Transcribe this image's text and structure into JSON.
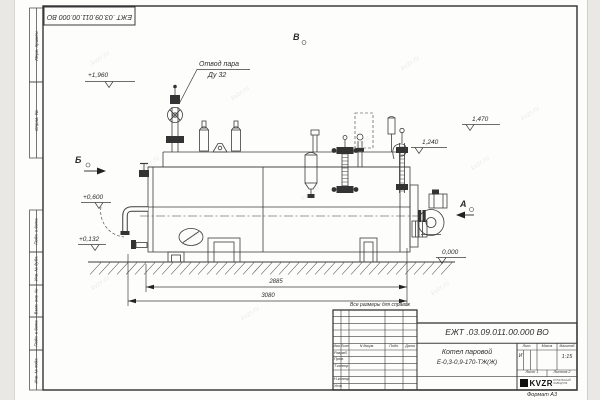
{
  "sheet": {
    "doc_number": "ЕЖТ .03.09.011.00.000  ВО",
    "format_note": "Формат А3",
    "reference_note": "Все размеры для справок",
    "watermark": "kvzr.ru"
  },
  "margin_columns": {
    "perv_primen": "Перв. примен.",
    "sprav_no": "Справ. №",
    "podp_data_1": "Подп. и дата",
    "inv_dubl": "Инв. № дубл.",
    "vzam_inv": "Взам. инв. №",
    "podp_data_2": "Подп. и дата",
    "inv_podl": "Инв. № подл."
  },
  "drawing": {
    "callout_line1": "Отвод пара",
    "callout_line2": "Ду 32",
    "view_b": "Б",
    "view_v": "В",
    "view_a": "А",
    "elev_plus_1960": "+1,960",
    "elev_plus_0600": "+0,600",
    "elev_plus_0132": "+0,132",
    "elev_1470": "1,470",
    "elev_1240": "1,240",
    "elev_0000": "0,000",
    "dim_width_inner": "2885",
    "dim_width_total": "3080"
  },
  "title_block": {
    "product_title_line1": "Котел паровой",
    "product_title_line2": "Е-0,3-0,9-170-ТЖ(Ж)",
    "col_izm": "Изм.",
    "col_list": "Лист",
    "col_doc": "N докум.",
    "col_podp": "Подп.",
    "col_data": "Дата",
    "row_razrab": "Разраб.",
    "row_prov": "Пров.",
    "row_tkontr": "Т.контр.",
    "row_nkontr": "Н.контр.",
    "row_utv": "Утв.",
    "lit_label": "Лит.",
    "lit_value": "И",
    "massa_label": "Масса",
    "masshtab_label": "Масштаб",
    "scale_value": "1:15",
    "sheet_label": "Лист",
    "sheet_value": "1",
    "sheets_label": "Листов",
    "sheets_value": "2",
    "company_logo": "KVZR",
    "company_sub_line1": "КОТЕЛЬНЫЙ",
    "company_sub_line2": "ЗАВОД РФ"
  }
}
